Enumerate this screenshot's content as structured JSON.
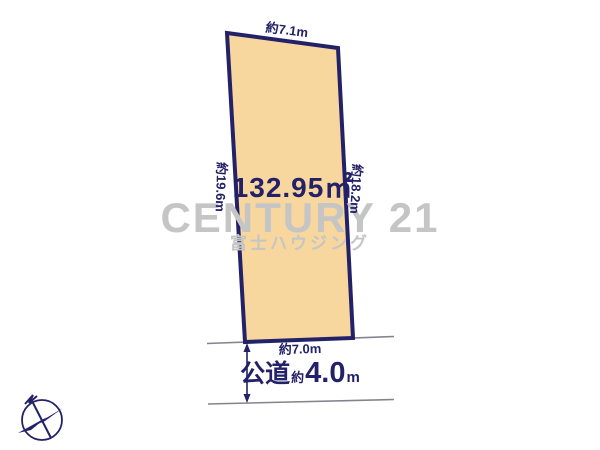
{
  "plot": {
    "area_label": "132.95㎡",
    "top_dim": "約7.1m",
    "left_dim": "約19.6m",
    "right_dim": "約18.2m",
    "bottom_dim": "約7.0m",
    "fill_color": "#f7d79e",
    "border_color": "#232168"
  },
  "road": {
    "type_label": "公道",
    "approx_label": "約",
    "width_value": "4.0",
    "unit_label": "m"
  },
  "watermark": {
    "brand": "CENTURY 21",
    "company": "富士ハウジング",
    "color": "#c5c5c5"
  },
  "colors": {
    "navy": "#232168",
    "road_line": "#84848e",
    "background": "#ffffff"
  }
}
